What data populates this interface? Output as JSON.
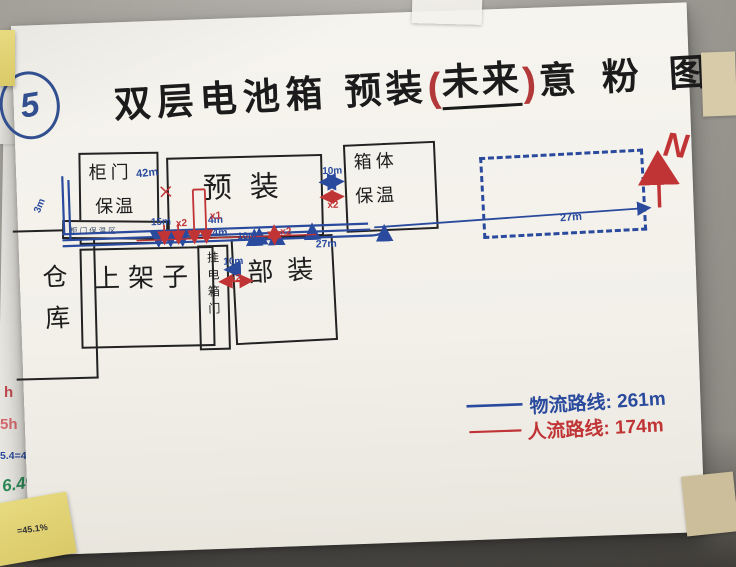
{
  "photo": {
    "circle_number": "5",
    "north_label": "N"
  },
  "title": {
    "part1": "双层电池箱",
    "part2": "预装",
    "paren_open": "(",
    "highlight": "未来",
    "paren_close": ")",
    "part3": "意",
    "part4": "粉",
    "part5": "图"
  },
  "rooms": {
    "warehouse": "仓库",
    "cabinet_line1": "柜门",
    "cabinet_line2": "保温",
    "strip_label": "柜门保温区",
    "preassembly": "预装",
    "box_insulation_line1": "箱体",
    "box_insulation_line2": "保温",
    "racking": "上架子",
    "hang_door": "挂电箱门",
    "subassembly": "部装"
  },
  "measurements": {
    "m3": "3m",
    "m42": "42m",
    "m15": "15m",
    "m4a": "4m",
    "m4b": "4m",
    "m10_sub": "10m",
    "m10_door": "10m",
    "m10_corridor": "10m",
    "m27_a": "27m",
    "m27_b": "27m",
    "x1": "x1",
    "x2_bundle": "x2",
    "x2_sub": "x2",
    "x2_door": "x2",
    "x2_corridor": "x2"
  },
  "legend": {
    "material_flow": "物流路线: 261m",
    "people_flow": "人流路线: 174m"
  },
  "side_notes": {
    "note1": "h",
    "note2": "5h",
    "note3": "5.4=46.5h",
    "note4": "6.4%",
    "sticky_note": "=45.1%"
  },
  "colors": {
    "material_blue": "#2a4a9e",
    "people_red": "#c13436",
    "marker_black": "#1f1f1f"
  }
}
